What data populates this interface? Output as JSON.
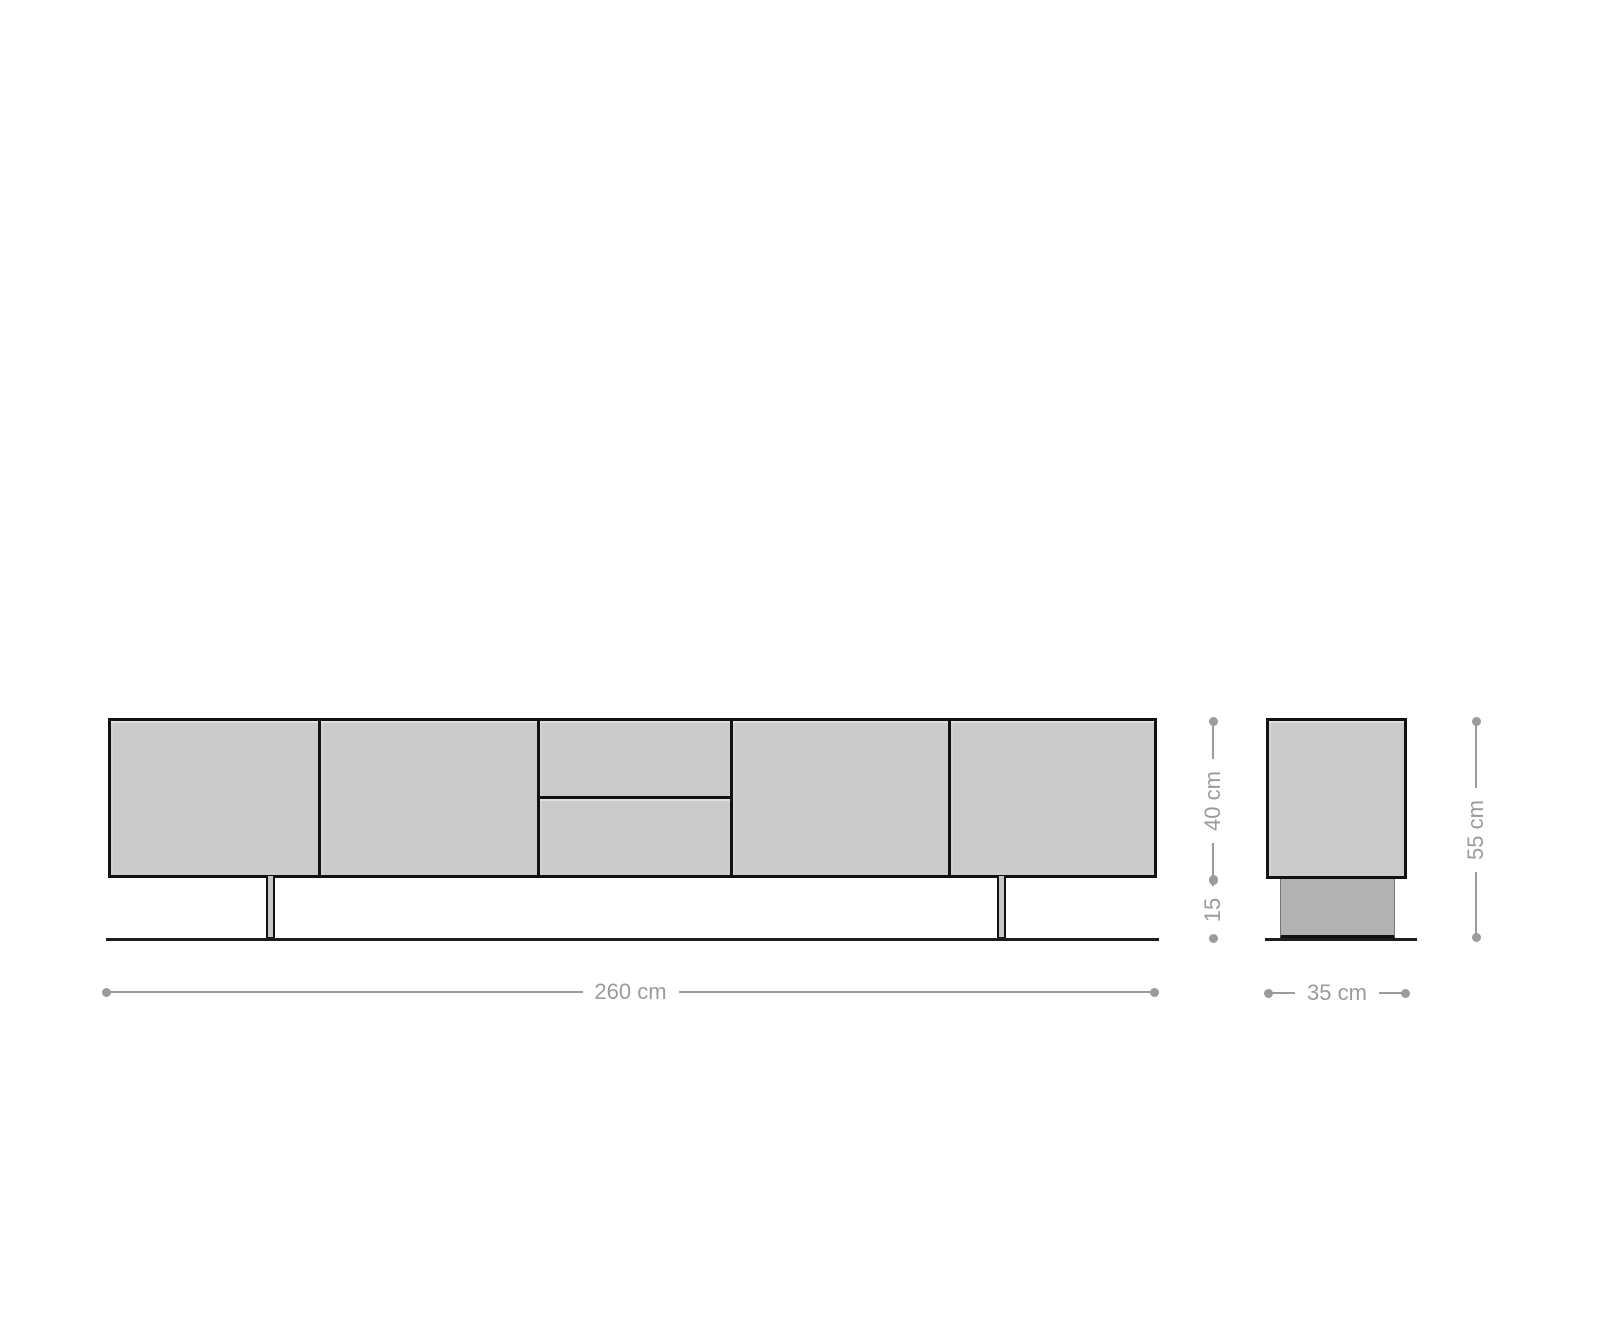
{
  "diagram": {
    "colors": {
      "background": "#ffffff",
      "panel_fill": "#cbcbcb",
      "plinth_fill": "#b2b2b2",
      "outline": "#111111",
      "floor_line": "#1d1d1d",
      "dimension": "#9b9b9b"
    },
    "dimensions": {
      "width": {
        "label": "260 cm"
      },
      "body_height": {
        "label": "40 cm"
      },
      "base_height": {
        "label": "15"
      },
      "total_height": {
        "label": "55 cm"
      },
      "depth": {
        "label": "35 cm"
      }
    }
  }
}
